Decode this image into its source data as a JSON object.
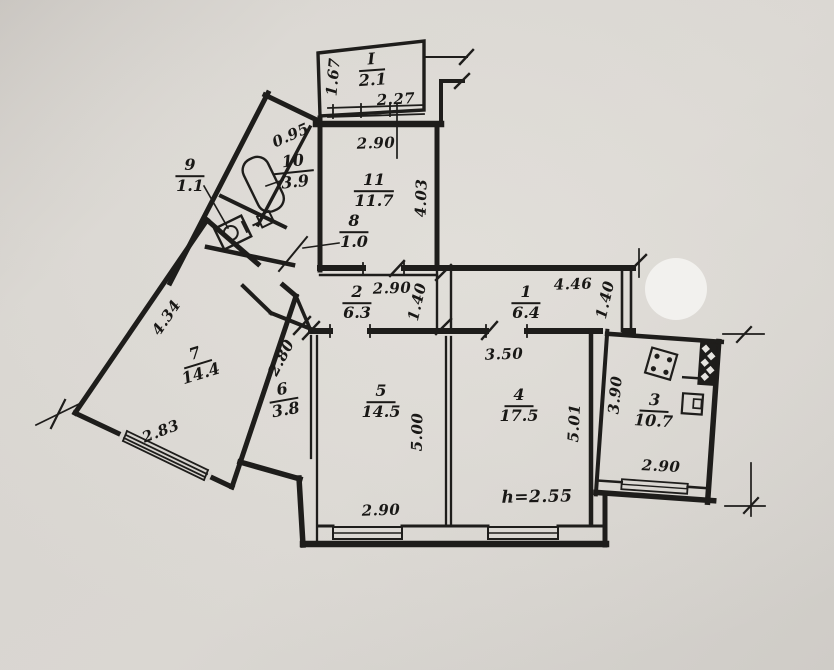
{
  "plan": {
    "title": "apartment floor plan (scanned blueprint)",
    "rooms": {
      "balcony": {
        "number": "I",
        "area": "2.1"
      },
      "r1": {
        "number": "1",
        "area": "6.4"
      },
      "r2": {
        "number": "2",
        "area": "6.3"
      },
      "r3": {
        "number": "3",
        "area": "10.7"
      },
      "r4": {
        "number": "4",
        "area": "17.5"
      },
      "r5": {
        "number": "5",
        "area": "14.5"
      },
      "r6": {
        "number": "6",
        "area": "3.8"
      },
      "r7": {
        "number": "7",
        "area": "14.4"
      },
      "r8": {
        "number": "8",
        "area": "1.0"
      },
      "r9": {
        "number": "9",
        "area": "1.1"
      },
      "r10": {
        "number": "10",
        "area": "3.9"
      },
      "r11": {
        "number": "11",
        "area": "11.7"
      }
    },
    "dims": {
      "balcony_width": "1.67",
      "balcony_len": "2.27",
      "r11_top": "2.90",
      "r11_side": "4.03",
      "band": "0.95",
      "hall2_w": "2.90",
      "hall2_d": "1.40",
      "hall1_w": "4.46",
      "hall1_d": "1.40",
      "r7_side": "4.34",
      "r7_bottom": "2.83",
      "r6_side": "2.80",
      "r4_top": "3.50",
      "r5_side": "5.00",
      "r4_side": "5.01",
      "r5_bottom": "2.90",
      "kitchen_side": "3.90",
      "kitchen_bottom": "2.90",
      "height_note": "h=2.55"
    },
    "ink": "#1e1d1b",
    "paper": "#d6d3ce"
  }
}
